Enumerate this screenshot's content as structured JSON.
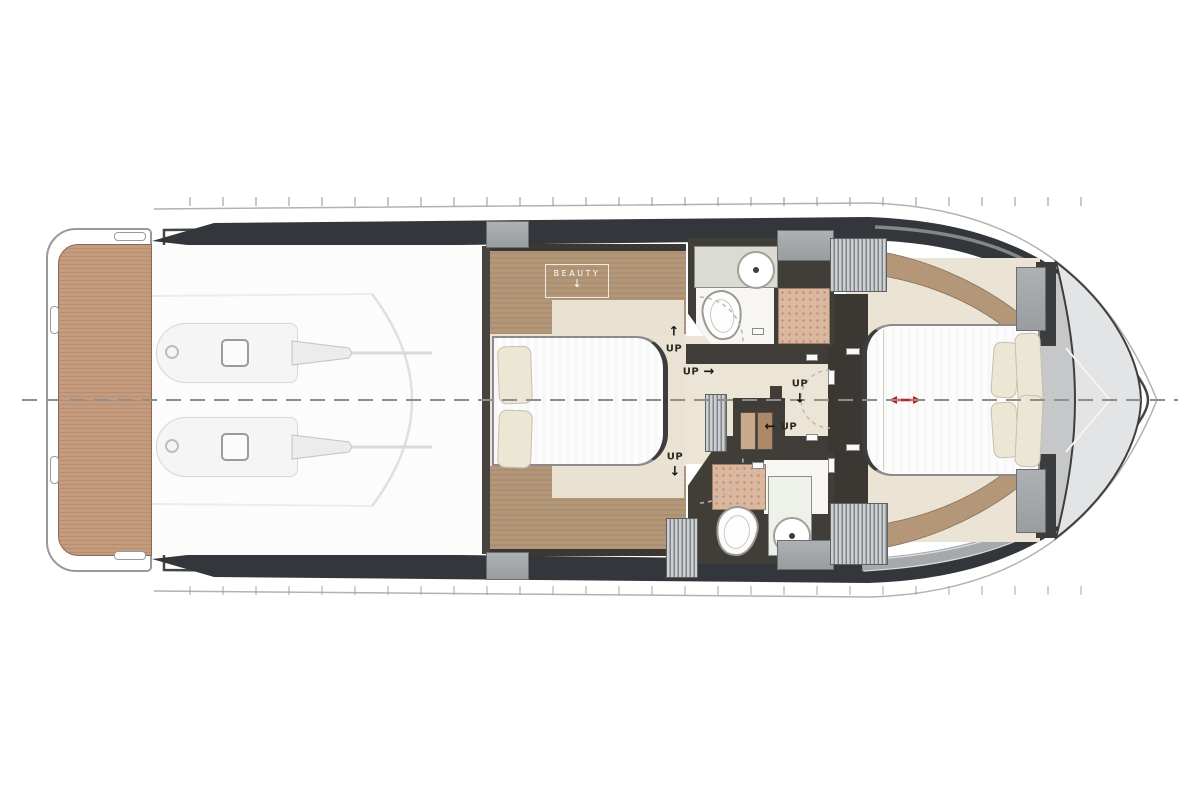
{
  "diagram": {
    "type": "yacht-lower-deck-floorplan",
    "labels": {
      "beauty": "BEAUTY",
      "beauty_arrow": "↓",
      "up": "UP",
      "arrow_up": "↑",
      "arrow_right": "→",
      "arrow_down": "↓",
      "arrow_left": "←"
    },
    "up_markers": [
      {
        "text": "UP",
        "direction": "up"
      },
      {
        "text": "UP",
        "direction": "right"
      },
      {
        "text": "UP",
        "direction": "down"
      },
      {
        "text": "UP",
        "direction": "left"
      },
      {
        "text": "UP",
        "direction": "down"
      }
    ],
    "colors": {
      "teak_deck": "#c59b7d",
      "wood_trim": "#b49778",
      "cabin_floor": "#eae3d4",
      "hull_band": "#33363a",
      "bow_gray": "#c5c7c9",
      "block_gray": "#a4a7a9",
      "shower_tile": "#dab79e",
      "pillow": "#ece6d4",
      "accent_red": "#ce1f1f",
      "centerline": "#8e8e8e"
    }
  }
}
